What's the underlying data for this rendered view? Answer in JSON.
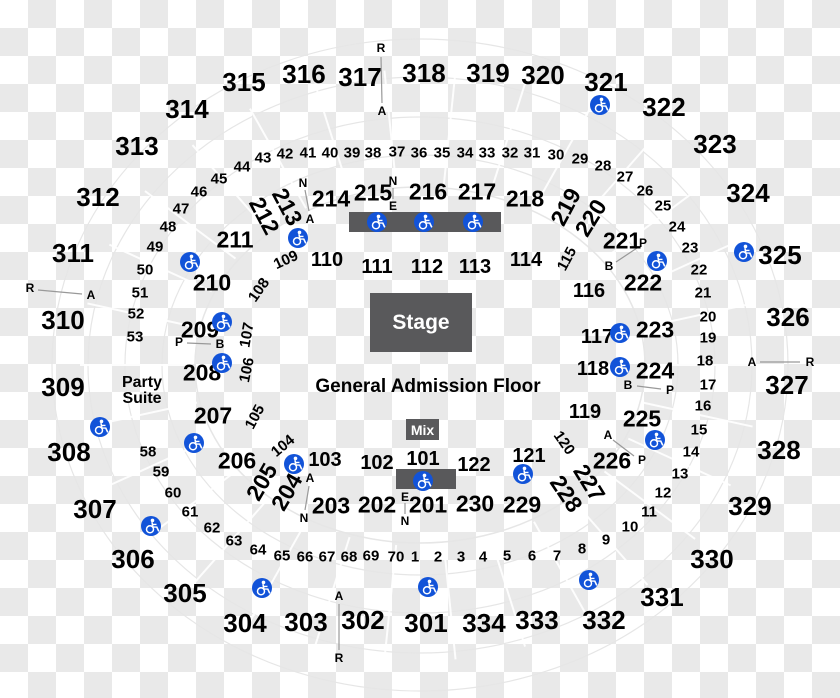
{
  "map_type": "arena-seating-map",
  "colors": {
    "accessible_blue": "#1253d8",
    "stage_gray": "#59595b",
    "checker_gray": "#e9e9e9",
    "ring_gray": "#e6e6e6",
    "marker_line_gray": "#999999"
  },
  "stage": {
    "label": "Stage"
  },
  "mix": {
    "label": "Mix"
  },
  "floor": {
    "label": "General Admission Floor"
  },
  "party_suite": {
    "line1": "Party",
    "line2": "Suite"
  },
  "boxes": {
    "stage": {
      "x": 370,
      "y": 293,
      "w": 102,
      "h": 59
    },
    "mix": {
      "x": 406,
      "y": 419,
      "w": 33,
      "h": 21
    },
    "top_bar": {
      "x": 349,
      "y": 212,
      "w": 152,
      "h": 20
    },
    "floor_bar": {
      "x": 396,
      "y": 469,
      "w": 60,
      "h": 20
    }
  },
  "text_positions": {
    "floor": {
      "x": 428,
      "y": 387
    },
    "party": {
      "x": 142,
      "y": 391
    }
  },
  "sections_300": [
    {
      "label": "301",
      "x": 426,
      "y": 623
    },
    {
      "label": "302",
      "x": 363,
      "y": 620
    },
    {
      "label": "303",
      "x": 306,
      "y": 622
    },
    {
      "label": "304",
      "x": 245,
      "y": 623
    },
    {
      "label": "305",
      "x": 185,
      "y": 593
    },
    {
      "label": "306",
      "x": 133,
      "y": 559
    },
    {
      "label": "307",
      "x": 95,
      "y": 509
    },
    {
      "label": "308",
      "x": 69,
      "y": 452
    },
    {
      "label": "309",
      "x": 63,
      "y": 387
    },
    {
      "label": "310",
      "x": 63,
      "y": 320
    },
    {
      "label": "311",
      "x": 73,
      "y": 253
    },
    {
      "label": "312",
      "x": 98,
      "y": 197
    },
    {
      "label": "313",
      "x": 137,
      "y": 146
    },
    {
      "label": "314",
      "x": 187,
      "y": 109
    },
    {
      "label": "315",
      "x": 244,
      "y": 82
    },
    {
      "label": "316",
      "x": 304,
      "y": 74
    },
    {
      "label": "317",
      "x": 360,
      "y": 77
    },
    {
      "label": "318",
      "x": 424,
      "y": 73
    },
    {
      "label": "319",
      "x": 488,
      "y": 73
    },
    {
      "label": "320",
      "x": 543,
      "y": 75
    },
    {
      "label": "321",
      "x": 606,
      "y": 82
    },
    {
      "label": "322",
      "x": 664,
      "y": 107
    },
    {
      "label": "323",
      "x": 715,
      "y": 144
    },
    {
      "label": "324",
      "x": 748,
      "y": 193
    },
    {
      "label": "325",
      "x": 780,
      "y": 255
    },
    {
      "label": "326",
      "x": 788,
      "y": 317
    },
    {
      "label": "327",
      "x": 787,
      "y": 385
    },
    {
      "label": "328",
      "x": 779,
      "y": 450
    },
    {
      "label": "329",
      "x": 750,
      "y": 506
    },
    {
      "label": "330",
      "x": 712,
      "y": 559
    },
    {
      "label": "331",
      "x": 662,
      "y": 597
    },
    {
      "label": "332",
      "x": 604,
      "y": 620
    },
    {
      "label": "333",
      "x": 537,
      "y": 620
    },
    {
      "label": "334",
      "x": 484,
      "y": 623
    }
  ],
  "sections_200": [
    {
      "label": "201",
      "x": 428,
      "y": 505
    },
    {
      "label": "202",
      "x": 377,
      "y": 505
    },
    {
      "label": "203",
      "x": 331,
      "y": 506
    },
    {
      "label": "204",
      "x": 287,
      "y": 492,
      "rot": -60
    },
    {
      "label": "205",
      "x": 262,
      "y": 482,
      "rot": -60
    },
    {
      "label": "206",
      "x": 237,
      "y": 461
    },
    {
      "label": "207",
      "x": 213,
      "y": 416
    },
    {
      "label": "208",
      "x": 202,
      "y": 373
    },
    {
      "label": "209",
      "x": 200,
      "y": 330
    },
    {
      "label": "210",
      "x": 212,
      "y": 283
    },
    {
      "label": "211",
      "x": 235,
      "y": 240
    },
    {
      "label": "212",
      "x": 264,
      "y": 216,
      "rot": 62
    },
    {
      "label": "213",
      "x": 287,
      "y": 207,
      "rot": 62
    },
    {
      "label": "214",
      "x": 331,
      "y": 199
    },
    {
      "label": "215",
      "x": 373,
      "y": 193
    },
    {
      "label": "216",
      "x": 428,
      "y": 192
    },
    {
      "label": "217",
      "x": 477,
      "y": 192
    },
    {
      "label": "218",
      "x": 525,
      "y": 199
    },
    {
      "label": "219",
      "x": 566,
      "y": 207,
      "rot": -62
    },
    {
      "label": "220",
      "x": 591,
      "y": 218,
      "rot": -58
    },
    {
      "label": "221",
      "x": 622,
      "y": 241
    },
    {
      "label": "222",
      "x": 643,
      "y": 283
    },
    {
      "label": "223",
      "x": 655,
      "y": 330
    },
    {
      "label": "224",
      "x": 655,
      "y": 371
    },
    {
      "label": "225",
      "x": 642,
      "y": 419
    },
    {
      "label": "226",
      "x": 612,
      "y": 461
    },
    {
      "label": "227",
      "x": 589,
      "y": 483,
      "rot": 58
    },
    {
      "label": "228",
      "x": 566,
      "y": 494,
      "rot": 56
    },
    {
      "label": "229",
      "x": 522,
      "y": 505
    },
    {
      "label": "230",
      "x": 475,
      "y": 504
    }
  ],
  "sections_100": [
    {
      "label": "101",
      "x": 423,
      "y": 459
    },
    {
      "label": "102",
      "x": 377,
      "y": 463
    },
    {
      "label": "103",
      "x": 325,
      "y": 460
    },
    {
      "label": "104",
      "x": 283,
      "y": 446,
      "rot": -40,
      "small": true
    },
    {
      "label": "105",
      "x": 255,
      "y": 417,
      "rot": -62,
      "small": true
    },
    {
      "label": "106",
      "x": 247,
      "y": 370,
      "rot": -78,
      "small": true
    },
    {
      "label": "107",
      "x": 247,
      "y": 335,
      "rot": -80,
      "small": true
    },
    {
      "label": "108",
      "x": 259,
      "y": 290,
      "rot": -55,
      "small": true
    },
    {
      "label": "109",
      "x": 286,
      "y": 260,
      "rot": -25,
      "small": true
    },
    {
      "label": "110",
      "x": 327,
      "y": 260
    },
    {
      "label": "111",
      "x": 377,
      "y": 267
    },
    {
      "label": "112",
      "x": 427,
      "y": 267
    },
    {
      "label": "113",
      "x": 475,
      "y": 267
    },
    {
      "label": "114",
      "x": 526,
      "y": 260
    },
    {
      "label": "115",
      "x": 567,
      "y": 259,
      "rot": -62,
      "small": true
    },
    {
      "label": "116",
      "x": 589,
      "y": 291
    },
    {
      "label": "117",
      "x": 597,
      "y": 337
    },
    {
      "label": "118",
      "x": 593,
      "y": 369
    },
    {
      "label": "119",
      "x": 585,
      "y": 412
    },
    {
      "label": "120",
      "x": 564,
      "y": 443,
      "rot": 55,
      "small": true
    },
    {
      "label": "121",
      "x": 529,
      "y": 456
    },
    {
      "label": "122",
      "x": 474,
      "y": 465
    }
  ],
  "row_numbers": [
    {
      "label": "45",
      "x": 219,
      "y": 179
    },
    {
      "label": "44",
      "x": 242,
      "y": 167
    },
    {
      "label": "43",
      "x": 263,
      "y": 158
    },
    {
      "label": "42",
      "x": 285,
      "y": 154
    },
    {
      "label": "41",
      "x": 308,
      "y": 153
    },
    {
      "label": "40",
      "x": 330,
      "y": 153
    },
    {
      "label": "39",
      "x": 352,
      "y": 153
    },
    {
      "label": "38",
      "x": 373,
      "y": 153
    },
    {
      "label": "37",
      "x": 397,
      "y": 152
    },
    {
      "label": "36",
      "x": 419,
      "y": 153
    },
    {
      "label": "35",
      "x": 442,
      "y": 153
    },
    {
      "label": "34",
      "x": 465,
      "y": 153
    },
    {
      "label": "33",
      "x": 487,
      "y": 153
    },
    {
      "label": "32",
      "x": 510,
      "y": 153
    },
    {
      "label": "31",
      "x": 532,
      "y": 153
    },
    {
      "label": "30",
      "x": 556,
      "y": 155
    },
    {
      "label": "29",
      "x": 580,
      "y": 159
    },
    {
      "label": "28",
      "x": 603,
      "y": 166
    },
    {
      "label": "27",
      "x": 625,
      "y": 177
    },
    {
      "label": "26",
      "x": 645,
      "y": 191
    },
    {
      "label": "25",
      "x": 663,
      "y": 206
    },
    {
      "label": "24",
      "x": 677,
      "y": 227
    },
    {
      "label": "23",
      "x": 690,
      "y": 248
    },
    {
      "label": "22",
      "x": 699,
      "y": 270
    },
    {
      "label": "21",
      "x": 703,
      "y": 293
    },
    {
      "label": "20",
      "x": 708,
      "y": 317
    },
    {
      "label": "19",
      "x": 708,
      "y": 338
    },
    {
      "label": "18",
      "x": 705,
      "y": 361
    },
    {
      "label": "17",
      "x": 708,
      "y": 385
    },
    {
      "label": "16",
      "x": 703,
      "y": 406
    },
    {
      "label": "15",
      "x": 699,
      "y": 430
    },
    {
      "label": "14",
      "x": 691,
      "y": 452
    },
    {
      "label": "13",
      "x": 680,
      "y": 474
    },
    {
      "label": "12",
      "x": 663,
      "y": 493
    },
    {
      "label": "11",
      "x": 649,
      "y": 512
    },
    {
      "label": "10",
      "x": 630,
      "y": 527
    },
    {
      "label": "9",
      "x": 606,
      "y": 540
    },
    {
      "label": "8",
      "x": 582,
      "y": 549
    },
    {
      "label": "7",
      "x": 557,
      "y": 556
    },
    {
      "label": "6",
      "x": 532,
      "y": 556
    },
    {
      "label": "5",
      "x": 507,
      "y": 556
    },
    {
      "label": "4",
      "x": 483,
      "y": 557
    },
    {
      "label": "3",
      "x": 461,
      "y": 557
    },
    {
      "label": "2",
      "x": 438,
      "y": 557
    },
    {
      "label": "1",
      "x": 415,
      "y": 557
    },
    {
      "label": "70",
      "x": 396,
      "y": 557
    },
    {
      "label": "69",
      "x": 371,
      "y": 556
    },
    {
      "label": "68",
      "x": 349,
      "y": 557
    },
    {
      "label": "67",
      "x": 327,
      "y": 557
    },
    {
      "label": "66",
      "x": 305,
      "y": 557
    },
    {
      "label": "65",
      "x": 282,
      "y": 556
    },
    {
      "label": "64",
      "x": 258,
      "y": 550
    },
    {
      "label": "63",
      "x": 234,
      "y": 541
    },
    {
      "label": "62",
      "x": 212,
      "y": 528
    },
    {
      "label": "61",
      "x": 190,
      "y": 512
    },
    {
      "label": "60",
      "x": 173,
      "y": 493
    },
    {
      "label": "59",
      "x": 161,
      "y": 472
    },
    {
      "label": "58",
      "x": 148,
      "y": 452
    },
    {
      "label": "53",
      "x": 135,
      "y": 337
    },
    {
      "label": "52",
      "x": 136,
      "y": 314
    },
    {
      "label": "51",
      "x": 140,
      "y": 293
    },
    {
      "label": "50",
      "x": 145,
      "y": 270
    },
    {
      "label": "49",
      "x": 155,
      "y": 247
    },
    {
      "label": "48",
      "x": 168,
      "y": 227
    },
    {
      "label": "47",
      "x": 181,
      "y": 209
    },
    {
      "label": "46",
      "x": 199,
      "y": 192
    }
  ],
  "letter_markers": [
    {
      "label": "R",
      "x": 381,
      "y": 48
    },
    {
      "label": "A",
      "x": 382,
      "y": 111
    },
    {
      "label": "R",
      "x": 30,
      "y": 288
    },
    {
      "label": "A",
      "x": 91,
      "y": 295
    },
    {
      "label": "A",
      "x": 752,
      "y": 362
    },
    {
      "label": "R",
      "x": 810,
      "y": 362
    },
    {
      "label": "A",
      "x": 339,
      "y": 596
    },
    {
      "label": "R",
      "x": 339,
      "y": 658
    },
    {
      "label": "N",
      "x": 303,
      "y": 183
    },
    {
      "label": "A",
      "x": 310,
      "y": 219
    },
    {
      "label": "N",
      "x": 393,
      "y": 181
    },
    {
      "label": "E",
      "x": 393,
      "y": 206
    },
    {
      "label": "P",
      "x": 179,
      "y": 342
    },
    {
      "label": "B",
      "x": 220,
      "y": 344
    },
    {
      "label": "P",
      "x": 643,
      "y": 243
    },
    {
      "label": "B",
      "x": 609,
      "y": 266
    },
    {
      "label": "B",
      "x": 628,
      "y": 385
    },
    {
      "label": "P",
      "x": 670,
      "y": 390
    },
    {
      "label": "A",
      "x": 608,
      "y": 435
    },
    {
      "label": "P",
      "x": 642,
      "y": 460
    },
    {
      "label": "A",
      "x": 310,
      "y": 478
    },
    {
      "label": "N",
      "x": 304,
      "y": 518
    },
    {
      "label": "E",
      "x": 405,
      "y": 497
    },
    {
      "label": "N",
      "x": 405,
      "y": 521
    }
  ],
  "marker_lines": [
    {
      "x1": 381,
      "y1": 57,
      "x2": 382,
      "y2": 103
    },
    {
      "x1": 38,
      "y1": 290,
      "x2": 82,
      "y2": 294
    },
    {
      "x1": 760,
      "y1": 362,
      "x2": 800,
      "y2": 362
    },
    {
      "x1": 339,
      "y1": 604,
      "x2": 339,
      "y2": 650
    },
    {
      "x1": 305,
      "y1": 190,
      "x2": 309,
      "y2": 211
    },
    {
      "x1": 393,
      "y1": 188,
      "x2": 393,
      "y2": 199
    },
    {
      "x1": 187,
      "y1": 343,
      "x2": 211,
      "y2": 344
    },
    {
      "x1": 637,
      "y1": 248,
      "x2": 616,
      "y2": 262
    },
    {
      "x1": 637,
      "y1": 386,
      "x2": 661,
      "y2": 389
    },
    {
      "x1": 613,
      "y1": 440,
      "x2": 634,
      "y2": 456
    },
    {
      "x1": 309,
      "y1": 486,
      "x2": 305,
      "y2": 510
    },
    {
      "x1": 405,
      "y1": 503,
      "x2": 405,
      "y2": 514
    }
  ],
  "wheelchair_icons": [
    {
      "x": 600,
      "y": 105
    },
    {
      "x": 744,
      "y": 252
    },
    {
      "x": 298,
      "y": 238
    },
    {
      "x": 190,
      "y": 262
    },
    {
      "x": 222,
      "y": 322
    },
    {
      "x": 222,
      "y": 363
    },
    {
      "x": 100,
      "y": 427
    },
    {
      "x": 194,
      "y": 443
    },
    {
      "x": 294,
      "y": 464
    },
    {
      "x": 423,
      "y": 481
    },
    {
      "x": 523,
      "y": 474
    },
    {
      "x": 620,
      "y": 333
    },
    {
      "x": 620,
      "y": 367
    },
    {
      "x": 657,
      "y": 261
    },
    {
      "x": 655,
      "y": 440
    },
    {
      "x": 377,
      "y": 222
    },
    {
      "x": 424,
      "y": 222
    },
    {
      "x": 473,
      "y": 222
    },
    {
      "x": 151,
      "y": 526
    },
    {
      "x": 262,
      "y": 588
    },
    {
      "x": 428,
      "y": 587
    },
    {
      "x": 589,
      "y": 580
    }
  ]
}
